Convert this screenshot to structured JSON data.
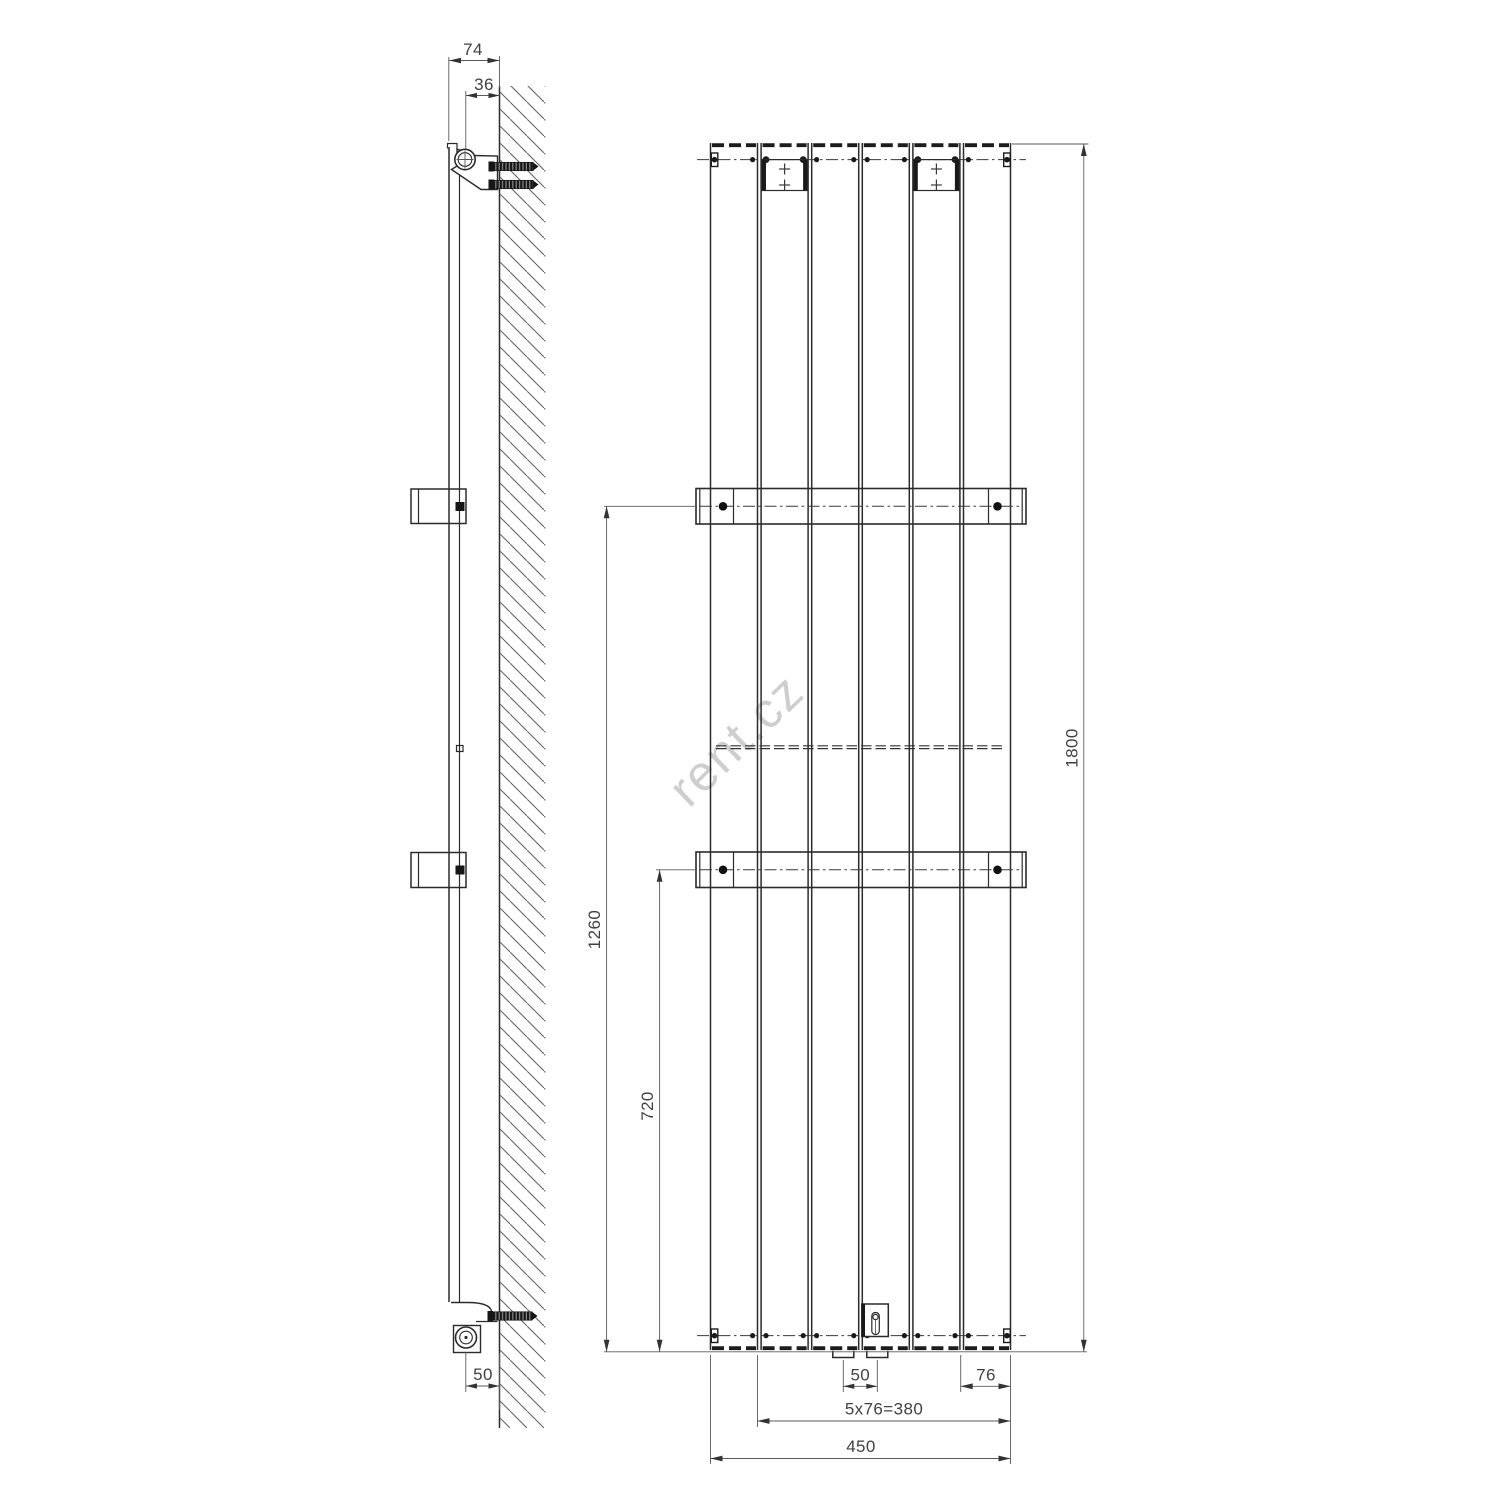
{
  "drawing": {
    "title": "radiator-technical-drawing",
    "watermark": "rent.cz",
    "side_view": {
      "dim_depth_total": "74",
      "dim_pipe_to_wall": "36",
      "dim_bottom_pipe_to_wall": "50"
    },
    "front_view": {
      "dim_height": "1800",
      "dim_upper_bracket_from_bottom": "1260",
      "dim_lower_bracket_from_bottom": "720",
      "dim_connection_spacing": "50",
      "dim_end_pitch": "76",
      "dim_pitch_formula": "5x76=380",
      "dim_width": "450"
    },
    "colors": {
      "line": "#2b2b2b",
      "dimension_line": "#5a5a5a",
      "watermark": "#c9c9c9",
      "background": "#ffffff"
    }
  }
}
